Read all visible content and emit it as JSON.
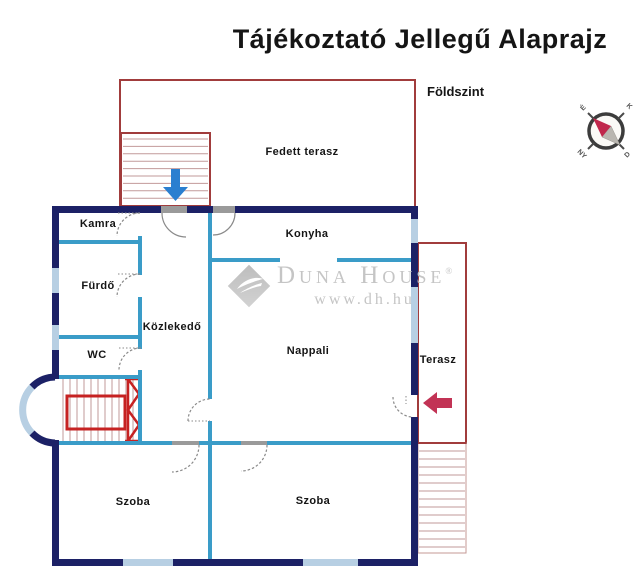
{
  "title": "Tájékoztató Jellegű Alaprajz",
  "floor_label": "Földszint",
  "compass": {
    "nw": "É",
    "ne": "K",
    "sw": "NY",
    "se": "D"
  },
  "rooms": {
    "fedett_terasz": "Fedett terasz",
    "kamra": "Kamra",
    "konyha": "Konyha",
    "fuerdo": "Fürdő",
    "kozlekedo": "Közlekedő",
    "wc": "WC",
    "nappali": "Nappali",
    "terasz": "Terasz",
    "szoba_bal": "Szoba",
    "szoba_jobb": "Szoba"
  },
  "watermark": {
    "brand": "Duna House",
    "registered": "®",
    "url": "www.dh.hu"
  },
  "colors": {
    "wall-ext": "#1c2166",
    "wall-int": "#3a9cc8",
    "window": "#b7cfe3",
    "red-outline": "#a13c3c",
    "red-bold": "#c62222",
    "tread": "#c29a9a",
    "arrow-blue": "#2b7fd0",
    "arrow-red": "#c23355",
    "text": "#151515",
    "watermark-gray": "#c5c5c5"
  }
}
